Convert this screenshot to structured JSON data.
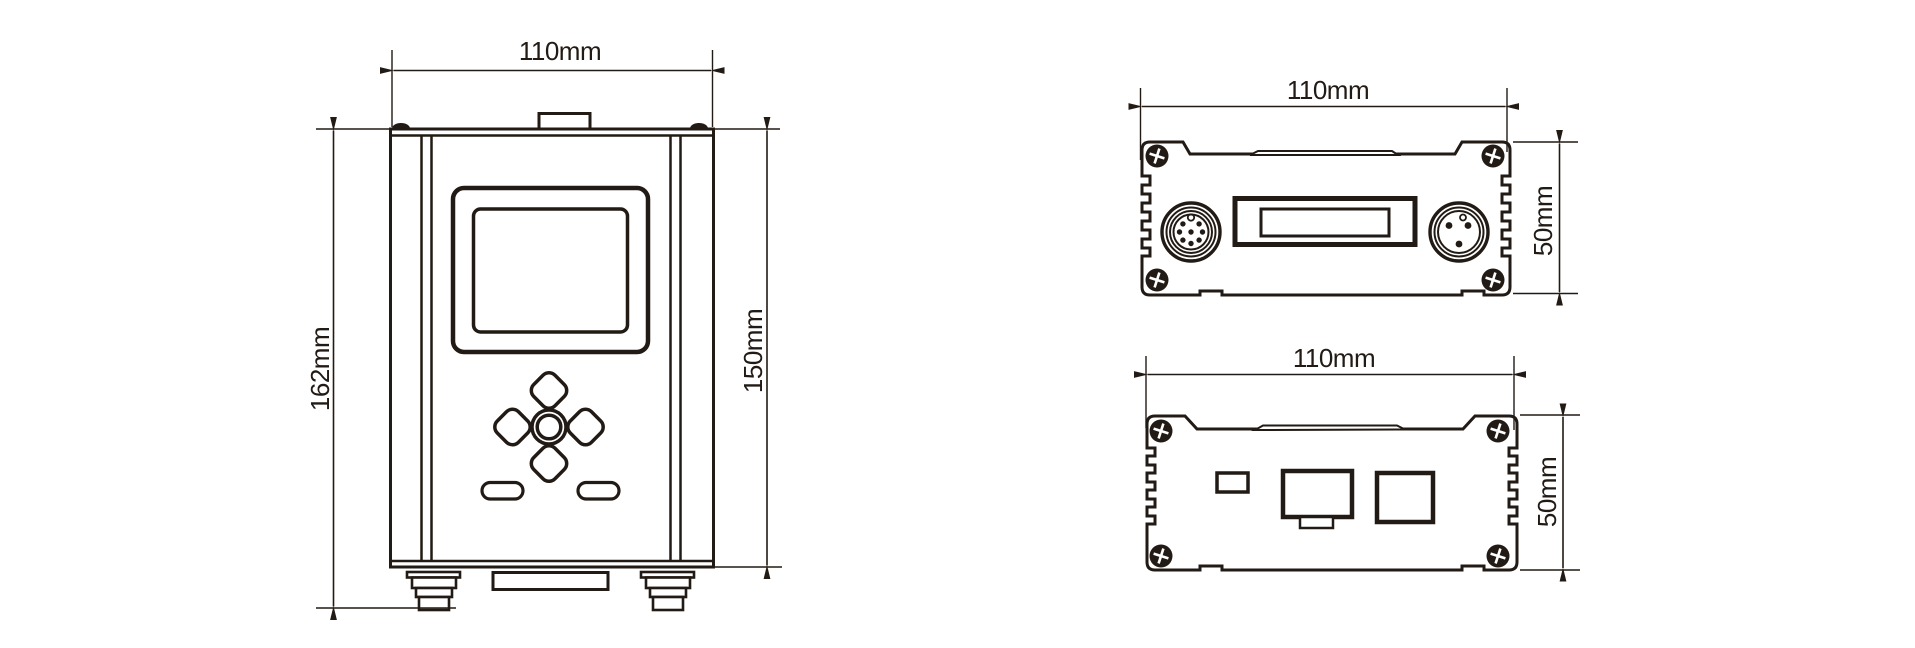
{
  "colors": {
    "ink": "#221a14",
    "background": "#ffffff"
  },
  "dimensions": {
    "front_width": "110mm",
    "front_overall_height": "162mm",
    "front_body_height": "150mm",
    "rear_width": "110mm",
    "rear_height": "50mm",
    "bottom_width": "110mm",
    "bottom_height": "50mm"
  }
}
